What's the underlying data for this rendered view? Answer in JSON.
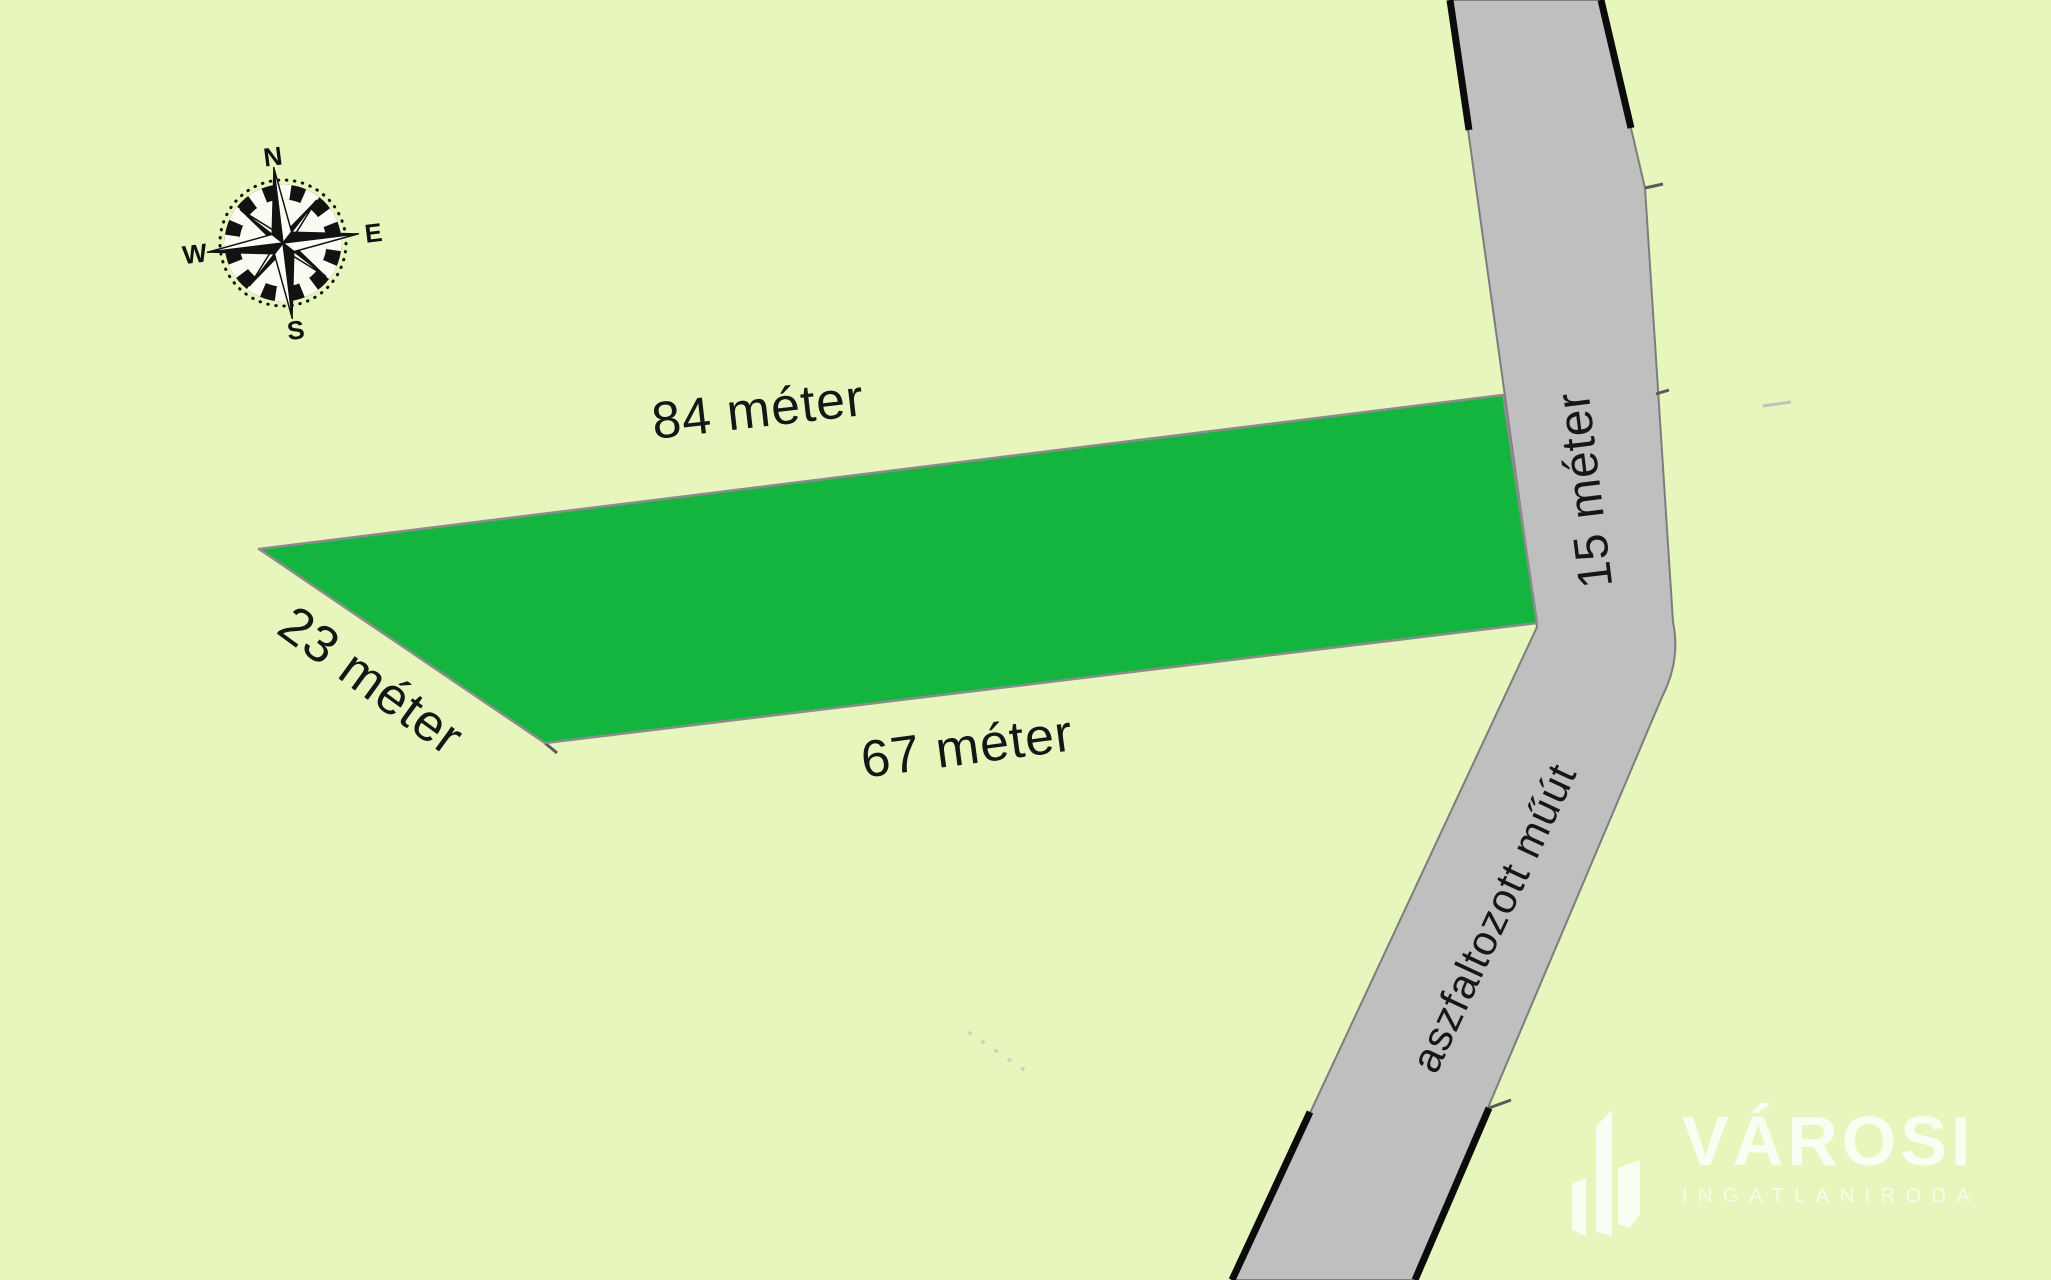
{
  "map": {
    "dimensions": {
      "top": "84 méter",
      "left": "23 méter",
      "bottom": "67 méter",
      "right": "15 méter"
    },
    "road_label": "aszfaltozott műút",
    "compass": {
      "north": "N",
      "east": "E",
      "south": "S",
      "west": "W"
    },
    "colors": {
      "background": "#e6f6bd",
      "parcel": "#13b53f",
      "parcel_border": "#8c8c8c",
      "road": "#bfbfbf",
      "road_border": "#7d7d7d",
      "label_text": "#161616"
    }
  },
  "watermark": {
    "brand": "VÁROSI",
    "subtitle": "INGATLANIRODA"
  }
}
